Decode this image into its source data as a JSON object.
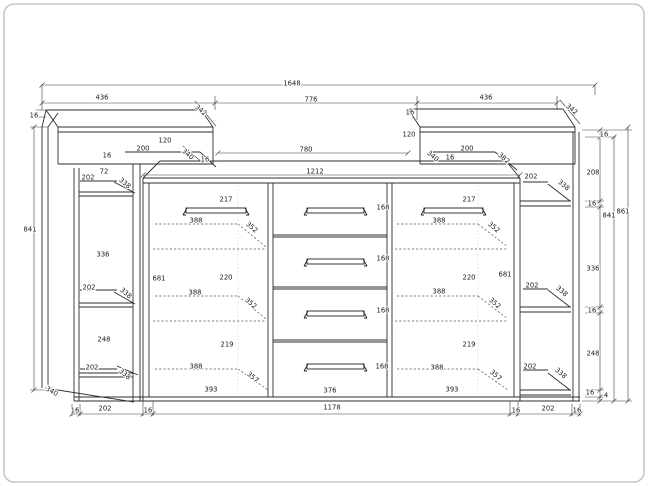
{
  "drawing": {
    "kind": "furniture-technical-drawing",
    "subject": "sideboard front elevation with dimensions",
    "line_color": "#2e2e2e",
    "frame_color": "#c6c6c6",
    "labels": [
      {
        "text": "1648",
        "x": 292,
        "y": 83
      },
      {
        "text": "436",
        "x": 102,
        "y": 97
      },
      {
        "text": "776",
        "x": 311,
        "y": 99
      },
      {
        "text": "436",
        "x": 486,
        "y": 97
      },
      {
        "text": "342",
        "x": 201,
        "y": 110,
        "r": 40
      },
      {
        "text": "342",
        "x": 572,
        "y": 109,
        "r": 40
      },
      {
        "text": "16",
        "x": 34,
        "y": 115
      },
      {
        "text": "16",
        "x": 410,
        "y": 112
      },
      {
        "text": "120",
        "x": 165,
        "y": 140
      },
      {
        "text": "120",
        "x": 409,
        "y": 134
      },
      {
        "text": "200",
        "x": 143,
        "y": 148
      },
      {
        "text": "200",
        "x": 467,
        "y": 148
      },
      {
        "text": "340",
        "x": 188,
        "y": 154,
        "r": 40
      },
      {
        "text": "340",
        "x": 433,
        "y": 156,
        "r": 40
      },
      {
        "text": "16",
        "x": 205,
        "y": 159
      },
      {
        "text": "16",
        "x": 450,
        "y": 157
      },
      {
        "text": "382",
        "x": 504,
        "y": 158,
        "r": 40
      },
      {
        "text": "16",
        "x": 107,
        "y": 155
      },
      {
        "text": "72",
        "x": 104,
        "y": 171
      },
      {
        "text": "202",
        "x": 88,
        "y": 177
      },
      {
        "text": "338",
        "x": 125,
        "y": 183,
        "r": 40
      },
      {
        "text": "780",
        "x": 306,
        "y": 149
      },
      {
        "text": "1212",
        "x": 315,
        "y": 171
      },
      {
        "text": "202",
        "x": 531,
        "y": 176
      },
      {
        "text": "338",
        "x": 564,
        "y": 185,
        "r": 40
      },
      {
        "text": "16",
        "x": 604,
        "y": 134
      },
      {
        "text": "208",
        "x": 593,
        "y": 172
      },
      {
        "text": "16",
        "x": 592,
        "y": 203
      },
      {
        "text": "841",
        "x": 30,
        "y": 229
      },
      {
        "text": "336",
        "x": 103,
        "y": 254
      },
      {
        "text": "336",
        "x": 593,
        "y": 268
      },
      {
        "text": "217",
        "x": 226,
        "y": 199
      },
      {
        "text": "217",
        "x": 469,
        "y": 199
      },
      {
        "text": "388",
        "x": 196,
        "y": 220
      },
      {
        "text": "388",
        "x": 439,
        "y": 220
      },
      {
        "text": "352",
        "x": 252,
        "y": 227,
        "r": 40
      },
      {
        "text": "352",
        "x": 494,
        "y": 227,
        "r": 40
      },
      {
        "text": "681",
        "x": 159,
        "y": 278
      },
      {
        "text": "681",
        "x": 505,
        "y": 274
      },
      {
        "text": "220",
        "x": 226,
        "y": 277
      },
      {
        "text": "220",
        "x": 469,
        "y": 277
      },
      {
        "text": "388",
        "x": 195,
        "y": 292
      },
      {
        "text": "388",
        "x": 439,
        "y": 291
      },
      {
        "text": "352",
        "x": 251,
        "y": 303,
        "r": 40
      },
      {
        "text": "352",
        "x": 495,
        "y": 303,
        "r": 40
      },
      {
        "text": "202",
        "x": 89,
        "y": 287
      },
      {
        "text": "338",
        "x": 126,
        "y": 293,
        "r": 40
      },
      {
        "text": "202",
        "x": 532,
        "y": 285
      },
      {
        "text": "338",
        "x": 562,
        "y": 291,
        "r": 40
      },
      {
        "text": "16",
        "x": 592,
        "y": 310
      },
      {
        "text": "248",
        "x": 104,
        "y": 339
      },
      {
        "text": "248",
        "x": 593,
        "y": 353
      },
      {
        "text": "219",
        "x": 227,
        "y": 344
      },
      {
        "text": "219",
        "x": 469,
        "y": 344
      },
      {
        "text": "388",
        "x": 196,
        "y": 366
      },
      {
        "text": "388",
        "x": 437,
        "y": 367
      },
      {
        "text": "357",
        "x": 253,
        "y": 377,
        "r": 40
      },
      {
        "text": "357",
        "x": 496,
        "y": 375,
        "r": 40
      },
      {
        "text": "393",
        "x": 211,
        "y": 389
      },
      {
        "text": "393",
        "x": 452,
        "y": 389
      },
      {
        "text": "202",
        "x": 92,
        "y": 367
      },
      {
        "text": "338",
        "x": 125,
        "y": 374,
        "r": 40
      },
      {
        "text": "202",
        "x": 530,
        "y": 366
      },
      {
        "text": "338",
        "x": 561,
        "y": 373,
        "r": 40
      },
      {
        "text": "340",
        "x": 52,
        "y": 391,
        "r": 30
      },
      {
        "text": "16",
        "x": 590,
        "y": 392
      },
      {
        "text": "4",
        "x": 606,
        "y": 395
      },
      {
        "text": "841",
        "x": 609,
        "y": 215
      },
      {
        "text": "861",
        "x": 623,
        "y": 211
      },
      {
        "text": "168",
        "x": 383,
        "y": 207
      },
      {
        "text": "168",
        "x": 383,
        "y": 258
      },
      {
        "text": "168",
        "x": 383,
        "y": 310
      },
      {
        "text": "168",
        "x": 382,
        "y": 366
      },
      {
        "text": "376",
        "x": 330,
        "y": 390
      },
      {
        "text": "1178",
        "x": 332,
        "y": 407
      },
      {
        "text": "16",
        "x": 75,
        "y": 410
      },
      {
        "text": "202",
        "x": 105,
        "y": 408
      },
      {
        "text": "16",
        "x": 148,
        "y": 410
      },
      {
        "text": "16",
        "x": 516,
        "y": 410
      },
      {
        "text": "202",
        "x": 548,
        "y": 408
      },
      {
        "text": "16",
        "x": 577,
        "y": 410
      }
    ]
  }
}
